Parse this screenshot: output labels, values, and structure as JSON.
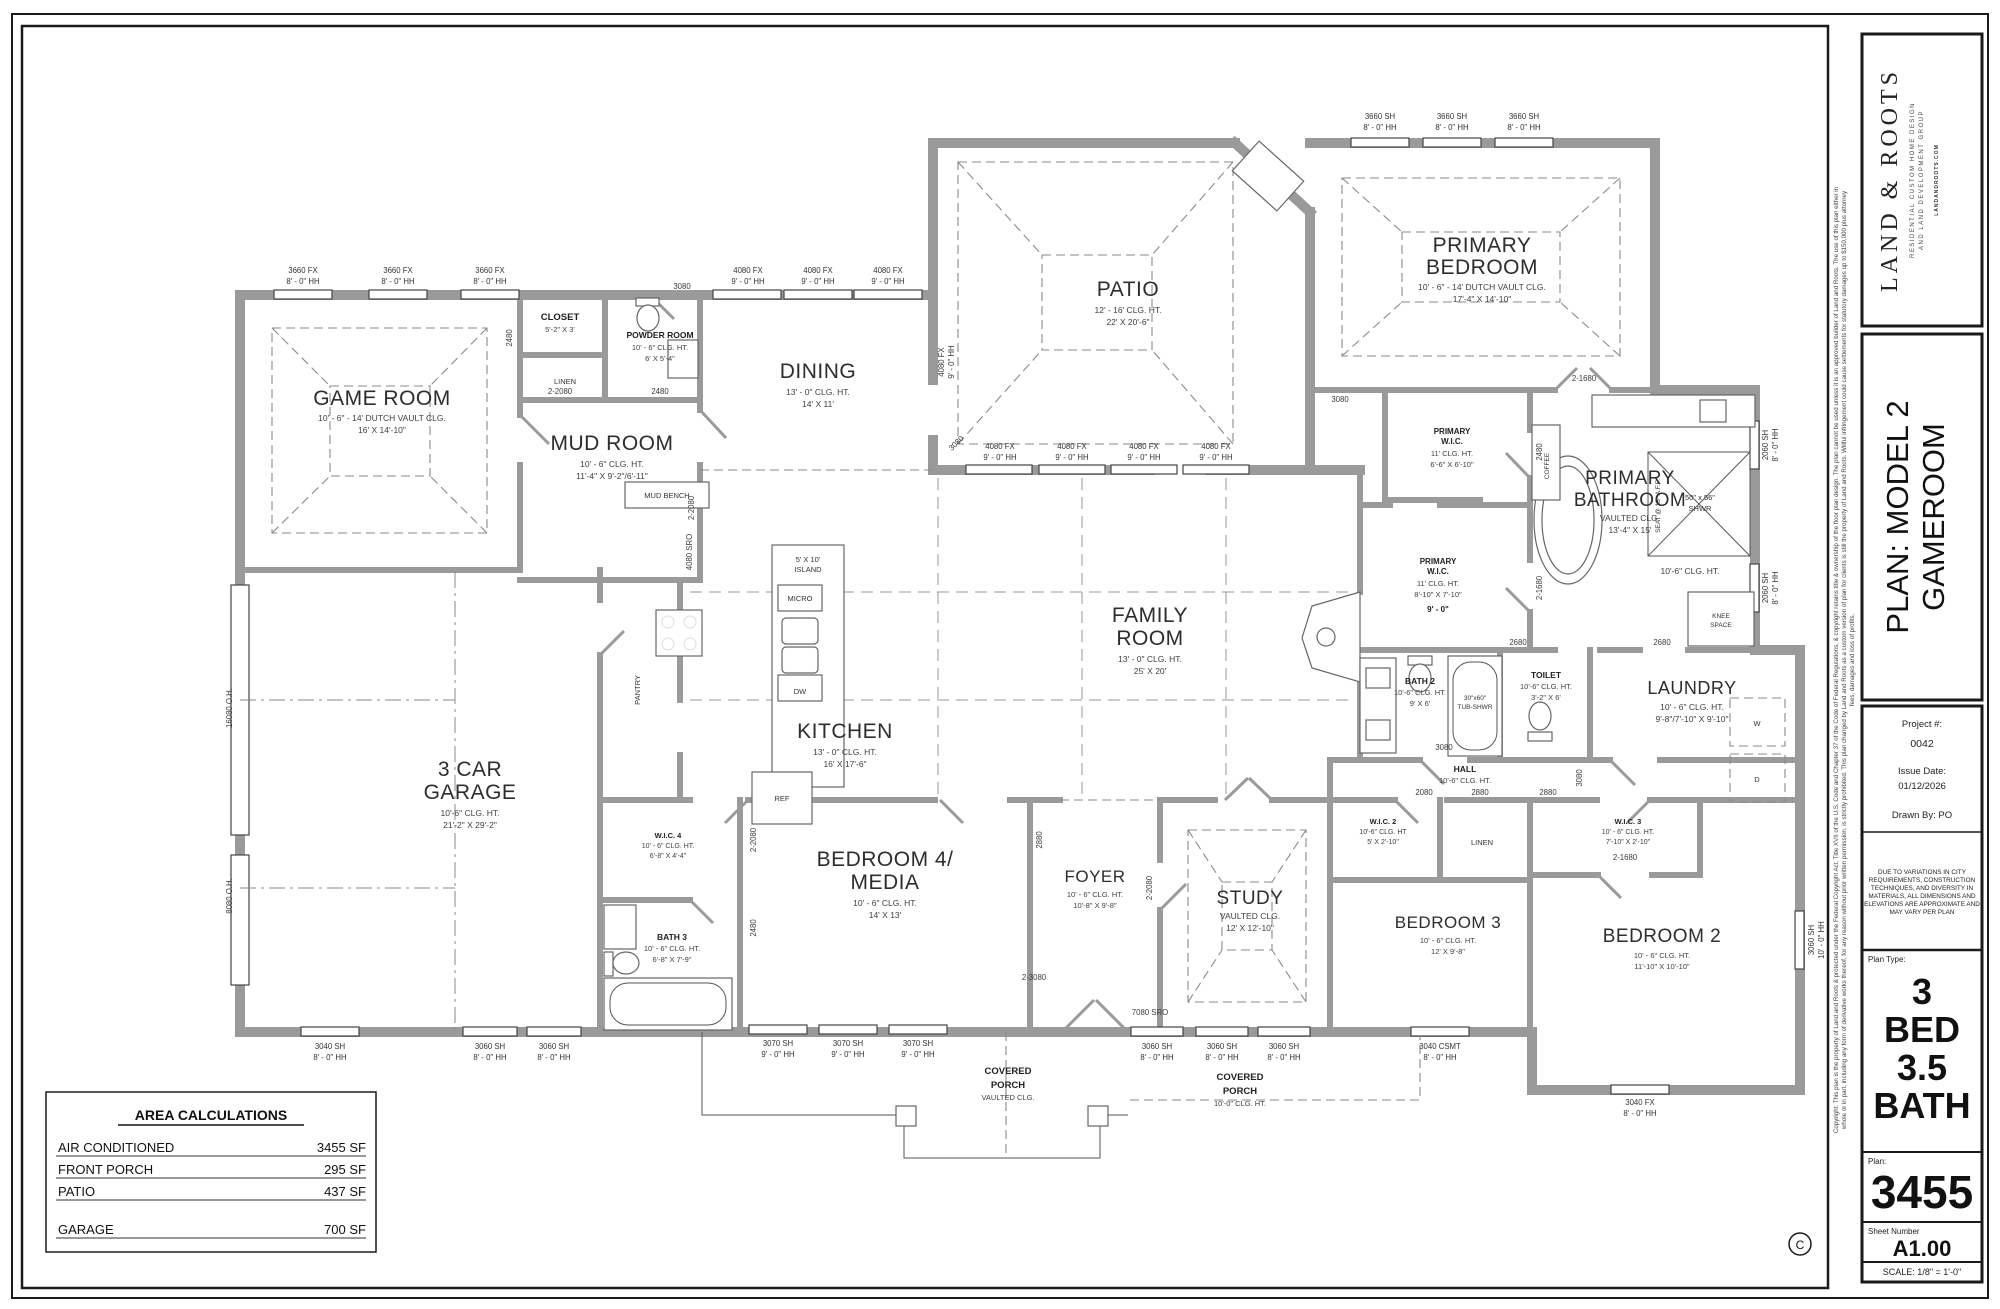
{
  "sheet_info": {
    "logo": {
      "title": "LAND & ROOTS",
      "subtitle1": "RESIDENTIAL CUSTOM HOME DESIGN",
      "subtitle2": "AND LAND DEVELOPMENT GROUP",
      "website": "LANDANDROOTS.COM"
    },
    "plan_title_line1": "PLAN: MODEL 2",
    "plan_title_line2": "GAMEROOM",
    "project": {
      "label": "Project #:",
      "number": "0042",
      "issue_label": "Issue Date:",
      "issue_date": "01/12/2026",
      "drawn_by": "Drawn By: PO"
    },
    "disclaimer": [
      "DUE TO VARIATIONS IN CITY",
      "REQUIREMENTS, CONSTRUCTION",
      "TECHNIQUES, AND DIVERSITY IN",
      "MATERIALS, ALL DIMENSIONS AND",
      "ELEVATIONS ARE APPROXIMATE AND",
      "MAY VARY PER PLAN"
    ],
    "plan_type": {
      "label": "Plan Type:",
      "lines": [
        "3",
        "BED",
        "3.5",
        "BATH"
      ]
    },
    "plan_number": {
      "label": "Plan:",
      "value": "3455"
    },
    "sheet_number": {
      "label": "Sheet Number",
      "value": "A1.00"
    },
    "scale": "SCALE: 1/8\" = 1'-0\"",
    "copyright_symbol": "C",
    "copyright_lines": [
      "Copyright: This plan is the property of Land and Roots & protected under the Federal Copyright Act, Title XVII of the U.S. Code and Chapter 37 of the Code of Federal Regulations, & copyright retains title & ownership of the floor plan design. The plan cannot be used unless it is an approved builder of Land and Roots. The use of this plan either in",
      "whole or in part, including any form of derivative works thereof, for any reason without prior written permission, is strictly prohibited. This plan changed by Land and Roots as a custom version of plan for clients is still the property of Land and Roots.  Willful infringement could cause settlements for statutory damages up to $150,000 plus attorney",
      "fees, damages and loss of profits."
    ]
  },
  "area_calculations": {
    "title": "AREA CALCULATIONS",
    "rows": [
      {
        "label": "AIR CONDITIONED",
        "value": "3455 SF"
      },
      {
        "label": "FRONT PORCH",
        "value": "295 SF"
      },
      {
        "label": "PATIO",
        "value": "437 SF"
      },
      {
        "label": "GARAGE",
        "value": "700 SF"
      }
    ]
  },
  "rooms": {
    "game": {
      "name": "GAME ROOM",
      "l1": "10' - 6\" - 14' DUTCH VAULT CLG.",
      "l2": "16' X 14'-10\""
    },
    "mud": {
      "name": "MUD ROOM",
      "l1": "10' - 6\" CLG. HT.",
      "l2": "11'-4\" X 9'-2\"/6'-11\""
    },
    "closet": {
      "name": "CLOSET",
      "l1": "5'-2\" X 3'"
    },
    "powder": {
      "name": "POWDER ROOM",
      "l1": "10' - 6\" CLG. HT.",
      "l2": "6' X 5'-4\""
    },
    "dining": {
      "name": "DINING",
      "l1": "13' - 0\" CLG. HT.",
      "l2": "14' X 11'"
    },
    "patio": {
      "name": "PATIO",
      "l1": "12' - 16' CLG. HT.",
      "l2": "22' X 20'-6\""
    },
    "primary": {
      "name1": "PRIMARY",
      "name2": "BEDROOM",
      "l1": "10' - 6\" - 14' DUTCH VAULT CLG.",
      "l2": "17'-4\" X 14'-10\""
    },
    "pwic1": {
      "name1": "PRIMARY",
      "name2": "W.I.C.",
      "l1": "11' CLG. HT.",
      "l2": "6'-6\" X 6'-10\""
    },
    "pbath": {
      "name1": "PRIMARY",
      "name2": "BATHROOM",
      "l1": "VAULTED CLG.",
      "l2": "13'-4\" X 15'"
    },
    "pwic2": {
      "name1": "PRIMARY",
      "name2": "W.I.C.",
      "l1": "11' CLG. HT.",
      "l2": "8'-10\" X 7'-10\"",
      "l3": "9' - 0\""
    },
    "family": {
      "name1": "FAMILY",
      "name2": "ROOM",
      "l1": "13' - 0\" CLG. HT.",
      "l2": "25' X 20'"
    },
    "kitchen": {
      "name": "KITCHEN",
      "l1": "13' - 0\" CLG. HT.",
      "l2": "16' X 17'-6\""
    },
    "garage": {
      "name1": "3 CAR",
      "name2": "GARAGE",
      "l1": "10'-6\" CLG. HT.",
      "l2": "21'-2\" X 29'-2\""
    },
    "bath2": {
      "name": "BATH 2",
      "l1": "10'-6\" CLG. HT.",
      "l2": "9' X 6'"
    },
    "toilet": {
      "name": "TOILET",
      "l1": "10'-6\" CLG. HT.",
      "l2": "3'-2\" X 6'"
    },
    "laundry": {
      "name": "LAUNDRY",
      "l1": "10' - 6\" CLG. HT.",
      "l2": "9'-8\"/7'-10\" X 9'-10\""
    },
    "hall": {
      "name": "HALL",
      "l1": "10'-6\" CLG. HT."
    },
    "wic2": {
      "name": "W.I.C. 2",
      "l1": "10'-6\" CLG. HT",
      "l2": "5' X 2'-10\""
    },
    "wic3": {
      "name": "W.I.C. 3",
      "l1": "10' - 6\" CLG. HT.",
      "l2": "7'-10\" X 2'-10\""
    },
    "wic4": {
      "name": "W.I.C. 4",
      "l1": "10' - 6\" CLG. HT.",
      "l2": "6'-8\" X 4'-4\""
    },
    "bath3": {
      "name": "BATH 3",
      "l1": "10' - 6\" CLG. HT.",
      "l2": "6'-8\" X 7'-9\""
    },
    "bed4": {
      "name1": "BEDROOM 4/",
      "name2": "MEDIA",
      "l1": "10' - 6\" CLG. HT.",
      "l2": "14' X 13'"
    },
    "foyer": {
      "name": "FOYER",
      "l1": "10' - 6\" CLG. HT.",
      "l2": "10'-8\" X 9'-8\""
    },
    "study": {
      "name": "STUDY",
      "l1": "VAULTED CLG.",
      "l2": "12' X 12'-10\""
    },
    "bed3": {
      "name": "BEDROOM 3",
      "l1": "10' - 6\" CLG. HT.",
      "l2": "12' X 9'-8\""
    },
    "bed2": {
      "name": "BEDROOM 2",
      "l1": "10' - 6\" CLG. HT.",
      "l2": "11'-10\" X 10'-10\""
    },
    "porch1": {
      "name1": "COVERED",
      "name2": "PORCH",
      "l1": "VAULTED CLG."
    },
    "porch2": {
      "name1": "COVERED",
      "name2": "PORCH",
      "l1": "10'-0\" CLG. HT."
    }
  },
  "windows": {
    "fx3660": "3660 FX",
    "fx4080": "4080 FX",
    "sh3660": "3660 SH",
    "sh2060": "2060 SH",
    "sh3060": "3060 SH",
    "sh3070": "3070 SH",
    "sh3040": "3040 SH",
    "csmt3040": "3040 CSMT",
    "fx3040": "3040 FX",
    "hh8": "8' - 0\" HH",
    "hh9": "9' - 0\" HH",
    "hh10": "10' - 0\" HH"
  },
  "openings": {
    "d3080": "3080",
    "d2480": "2480",
    "d2_2080": "2-2080",
    "d2_1680": "2-1680",
    "d2680": "2680",
    "d2880": "2880",
    "d2080": "2080",
    "d2_3080": "2-3080",
    "sro7080": "7080 SRO",
    "sro4080": "4080 SRO",
    "oh16080": "16080 O.H.",
    "oh8080": "8080 O.H."
  },
  "fixtures": {
    "island1": "5' X 10'",
    "island2": "ISLAND",
    "micro": "MICRO",
    "dw": "DW",
    "ref": "REF",
    "pantry": "PANTRY",
    "mud_bench": "MUD BENCH",
    "linen": "LINEN",
    "coffee": "COFFEE",
    "shower1": "50\" x 56\"",
    "shower2": "SHWR",
    "seat": "SEAT @ 18\" A.F.F.",
    "knee1": "KNEE",
    "knee2": "SPACE",
    "tub1": "30\"x60\"",
    "tub2": "TUB-SHWR",
    "washer": "W",
    "dryer": "D",
    "bath_clg": "10'-6\" CLG. HT."
  }
}
